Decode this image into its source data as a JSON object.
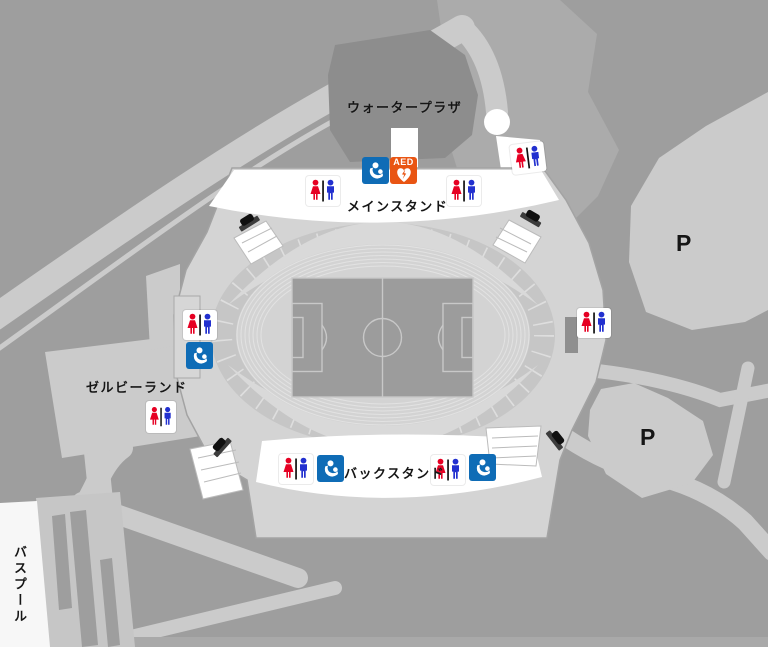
{
  "labels": {
    "water_plaza": "ウォータープラザ",
    "main_stand": "メインスタンド",
    "back_stand": "バックスタンド",
    "zelvia_land": "ゼルビーランド",
    "bus_pool": "バスプール",
    "parking_1": "P",
    "parking_2": "P"
  },
  "icons": {
    "aed_label": "AED",
    "toilet": "toilet-icon",
    "nursing_room": "nursing-room-icon",
    "aed": "aed-icon",
    "gate": "gate-icon"
  },
  "colors": {
    "ground_dark": "#9e9e9e",
    "road_light": "#cbcbcb",
    "plaza_dark": "#8d8d8d",
    "stadium_platform": "#d4d4d4",
    "field_gray": "#9c9c9c",
    "female_red": "#e60023",
    "male_blue": "#2230cf",
    "nursing_blue": "#0f6cb6",
    "aed_orange": "#e95513"
  }
}
